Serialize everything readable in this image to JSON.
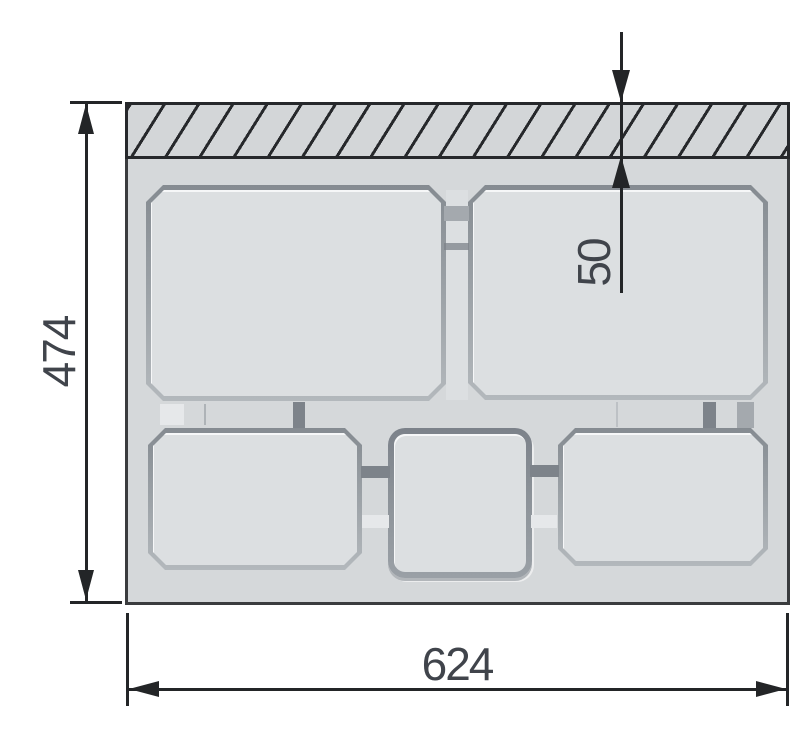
{
  "drawing": {
    "dim_height": "474",
    "dim_width": "624",
    "dim_depth": "50",
    "colors": {
      "background": "#ffffff",
      "tray_surface": "#d5d8da",
      "pocket_fill": "#dcdfe1",
      "pocket_edge_dark": "#858b91",
      "pocket_edge_light": "#b3b8bc",
      "connector_dark": "#7d838a",
      "connector_gray": "#a4a9ae",
      "tray_outline": "#3a3c3e",
      "hatch_line": "#26282b",
      "dimension_line": "#232527",
      "dimension_text": "#40444b"
    }
  }
}
